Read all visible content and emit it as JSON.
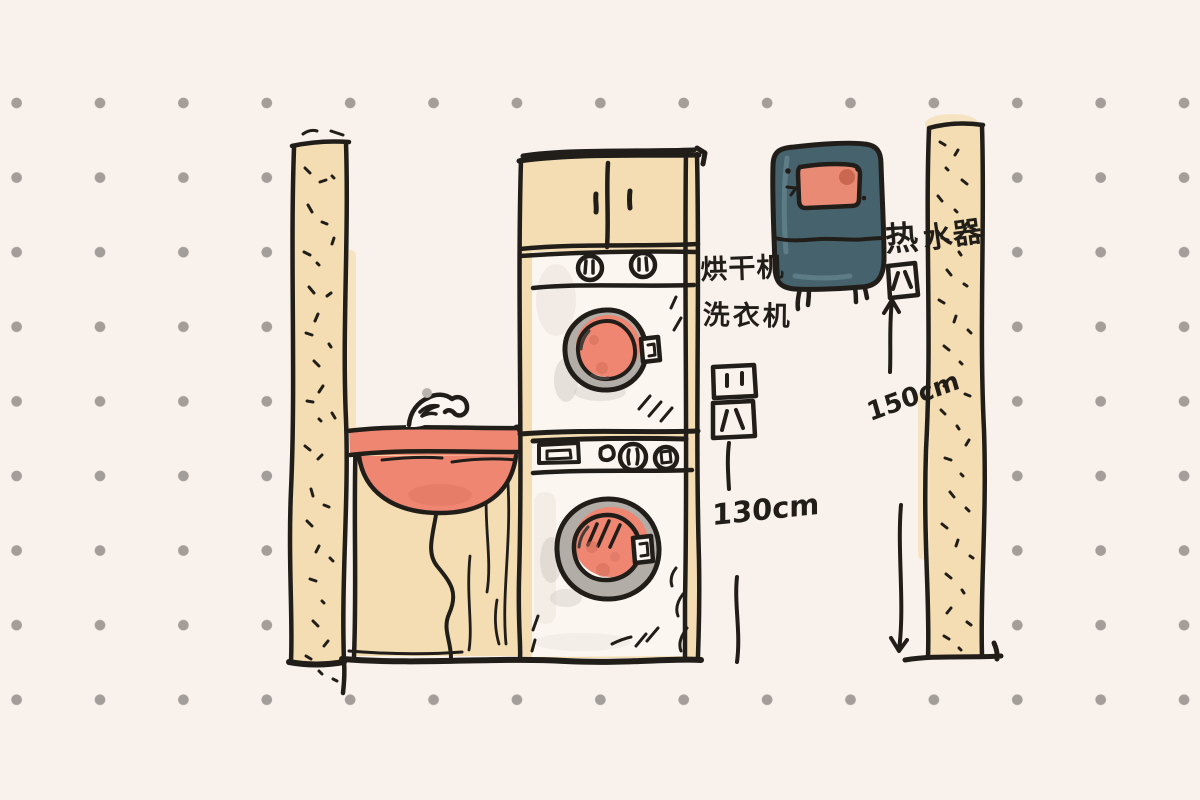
{
  "sketch": {
    "annotations": {
      "dryer_label": "烘干机",
      "washer_label": "洗衣机",
      "water_heater_label": "热水器",
      "water_heater_label_part1": "热",
      "water_heater_label_part2": "水器",
      "outlet_height_label": "130cm",
      "water_heater_height_label": "150cm"
    },
    "icons": {
      "outlet_top": "power-outlet",
      "outlet_bottom": "power-outlet",
      "outlet_water_heater": "power-outlet",
      "faucet": "faucet",
      "arrow_up": "arrow-up",
      "arrow_down": "arrow-down"
    },
    "colors": {
      "background": "#f8f1ec",
      "dot_gray": "#a39e99",
      "ink": "#211e1a",
      "wood_tan": "#f4ddb2",
      "wood_tan_soft": "#f6e3c1",
      "coral": "#ee8672",
      "coral_dark": "#cf6b55",
      "appliance_white": "#fbf6f0",
      "drum_ring_gray": "#b2ada7",
      "shadow_gray": "#cfc9c2",
      "heater_teal": "#46636d",
      "heater_window": "#e98a75"
    }
  }
}
